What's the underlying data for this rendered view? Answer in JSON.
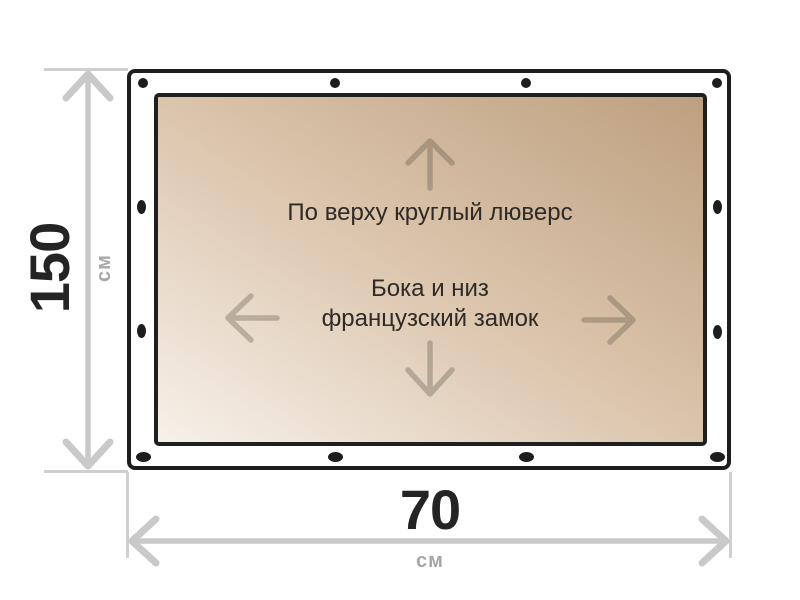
{
  "diagram": {
    "type": "banner-dimension-diagram",
    "notes": {
      "top": "По верху круглый люверс",
      "middle_line1": "Бока и низ",
      "middle_line2": "французский замок"
    },
    "height_dimension": {
      "value": "150",
      "unit": "см"
    },
    "width_dimension": {
      "value": "70",
      "unit": "см"
    },
    "grommets": {
      "top_count": 4,
      "bottom_count": 4,
      "left_count": 2,
      "right_count": 2
    },
    "colors": {
      "outline": "#1d1d1d",
      "grommet_dot": "#1d1d1d",
      "dimension_line": "#c9c9c9",
      "dimension_value_text": "#242424",
      "dimension_unit_text": "#a7a7a7",
      "note_text": "#2e2a25",
      "material_dark": "#bda07f",
      "material_light": "#f7f1ea",
      "direction_arrow": "rgba(85,78,68,0.33)"
    }
  }
}
